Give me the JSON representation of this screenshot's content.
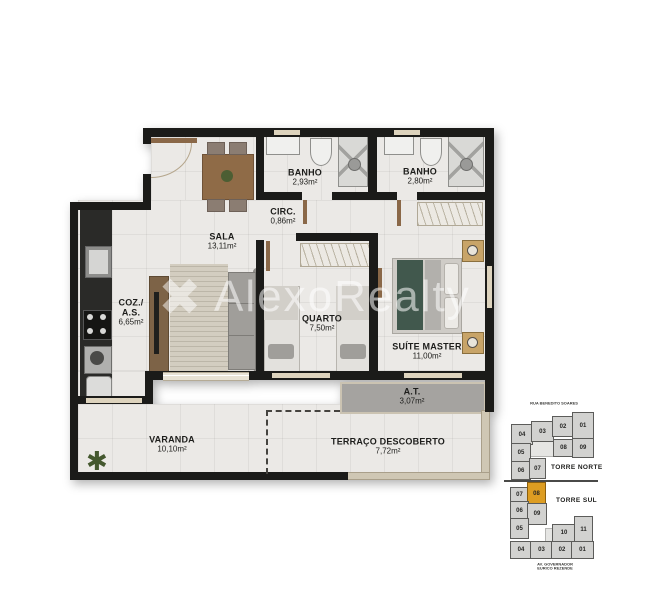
{
  "watermark": {
    "brand": "AlexoRealty",
    "logo_glyph": "✖"
  },
  "rooms": {
    "banho1": {
      "name": "BANHO",
      "area": "2,93m²"
    },
    "banho2": {
      "name": "BANHO",
      "area": "2,80m²"
    },
    "circ": {
      "name": "CIRC.",
      "area": "0,86m²"
    },
    "sala": {
      "name": "SALA",
      "area": "13,11m²"
    },
    "coz": {
      "name1": "COZ./",
      "name2": "A.S.",
      "area": "6,65m²"
    },
    "quarto": {
      "name": "QUARTO",
      "area": "7,50m²"
    },
    "suite": {
      "name": "SUÍTE MASTER",
      "area": "11,00m²"
    },
    "at": {
      "name": "A.T.",
      "area": "3,07m²"
    },
    "varanda": {
      "name": "VARANDA",
      "area": "10,10m²"
    },
    "terraco": {
      "name": "TERRAÇO DESCOBERTO",
      "area": "7,72m²"
    }
  },
  "keyplan": {
    "street_top": "RUA BENEDITO SOARES",
    "street_bottom": [
      "AV. GOVERNADOR",
      "EURICO REZENDE"
    ],
    "torre_norte": {
      "label": "TORRE NORTE",
      "units": [
        "04",
        "03",
        "02",
        "01",
        "08",
        "09",
        "05",
        "06",
        "07"
      ]
    },
    "torre_sul": {
      "label": "TORRE SUL",
      "units": [
        "07",
        "08",
        "06",
        "09",
        "05",
        "10",
        "11",
        "04",
        "03",
        "02",
        "01"
      ],
      "highlighted_unit": "08"
    },
    "colors": {
      "unit_fill": "#d2d2d0",
      "highlight_fill": "#dd9d22"
    }
  }
}
